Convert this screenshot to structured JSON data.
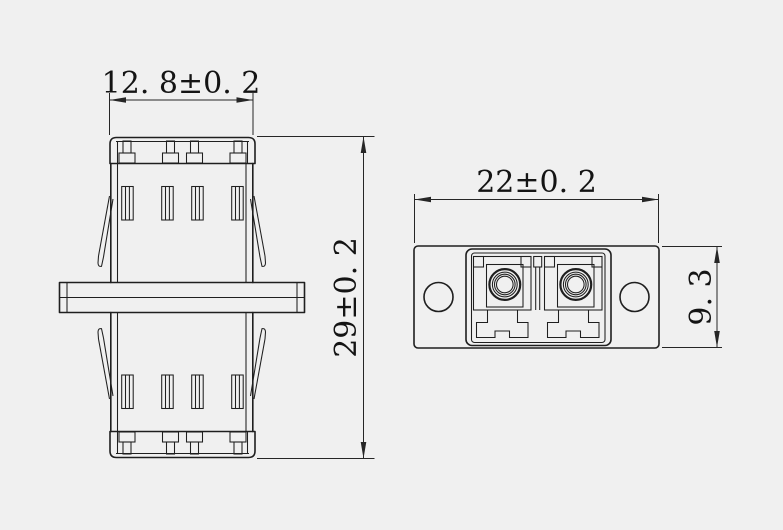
{
  "canvas": {
    "width": 783,
    "height": 530
  },
  "colors": {
    "background": "#f0f0f0",
    "line": "#1f1f1f",
    "dimension_line": "#262626",
    "text": "#141414"
  },
  "views": {
    "side_view": {
      "dimensions": {
        "width_label": "12. 8±0. 2",
        "height_label": "29±0. 2"
      }
    },
    "front_view": {
      "dimensions": {
        "width_label": "22±0. 2",
        "height_label": "9. 3"
      }
    }
  }
}
